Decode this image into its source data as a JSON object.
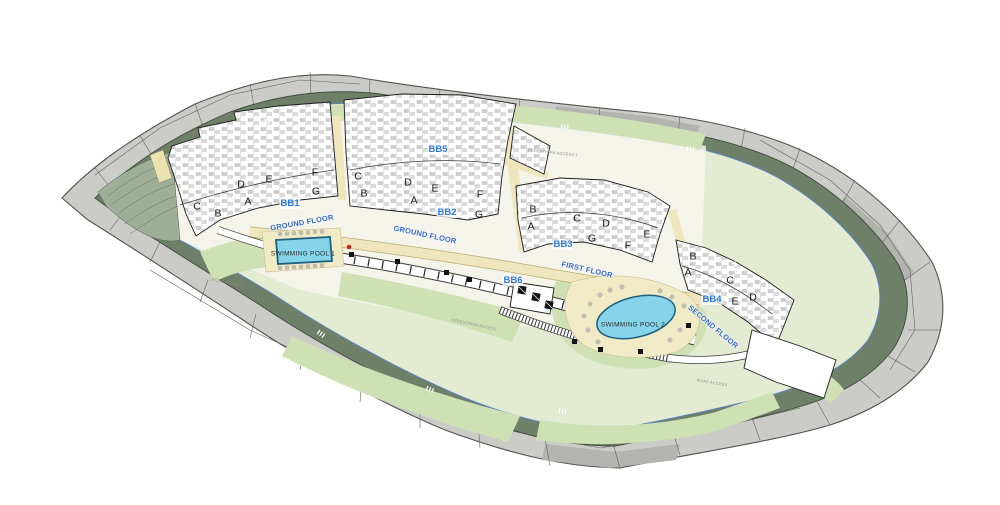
{
  "title": "Residential masterplan site plan",
  "colors": {
    "accent_blue": "#2e79d8",
    "label_blue": "#3466cc",
    "pool_water": "#86d4ea",
    "pool_outline": "#1f6080",
    "deck": "#f0eac6",
    "cream": "#efe6bd",
    "garden_green": "#cfe0b4",
    "inner_green": "#e3ebd3",
    "belt_green": "#6f8069",
    "outer_gray": "#cbcbc8",
    "boundary_blue": "#5b84c4",
    "red_marker": "#cc2222"
  },
  "blocks": [
    {
      "id": "BB1",
      "units": [
        "C",
        "B",
        "A",
        "D",
        "E",
        "F",
        "G"
      ]
    },
    {
      "id": "BB2",
      "units": [
        "C",
        "B",
        "D",
        "E",
        "A",
        "F",
        "G"
      ]
    },
    {
      "id": "BB3",
      "units": [
        "B",
        "A",
        "C",
        "D",
        "G",
        "E",
        "F"
      ]
    },
    {
      "id": "BB4",
      "units": [
        "B",
        "A",
        "C",
        "E",
        "D"
      ]
    },
    {
      "id": "BB5",
      "units": []
    },
    {
      "id": "BB6",
      "units": []
    }
  ],
  "floors": [
    {
      "text": "GROUND FLOOR"
    },
    {
      "text": "GROUND FLOOR"
    },
    {
      "text": "FIRST FLOOR"
    },
    {
      "text": "SECOND FLOOR"
    }
  ],
  "pools": [
    {
      "label": "SWIMMING POOL 1"
    },
    {
      "label": "SWIMMING POOL 2"
    }
  ],
  "access": [
    {
      "text": "ROAD ACCESS 1"
    },
    {
      "text": "PEDESTRIAN ACCESS 1"
    },
    {
      "text": "PEDESTRIAN ACCESS"
    },
    {
      "text": "ROAD ACCESS"
    }
  ]
}
